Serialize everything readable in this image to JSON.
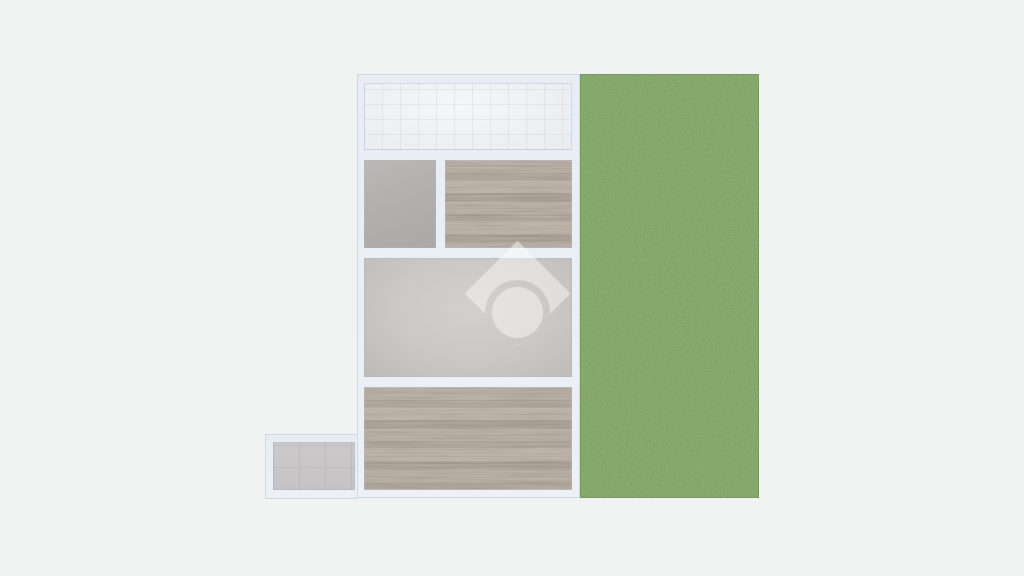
{
  "scene": {
    "background": "#f1f2f2",
    "width": 1024,
    "height": 576
  },
  "palette": {
    "wall_fill": "#e9eef4",
    "wall_edge": "#cdd8e4",
    "grass_green": "#7ba25f",
    "wood_brown": "#a79c8f",
    "concrete_gray": "#aeabа8",
    "plaster_gray": "#c8c5c2",
    "tile_white": "#eef0f2",
    "tile_gray": "#c6c4c5",
    "watermark_white": "rgba(255,255,255,0.44)"
  },
  "plan": {
    "walls": [
      {
        "name": "building-walls",
        "x": 357,
        "y": 74,
        "w": 223,
        "h": 424
      },
      {
        "name": "annex-walls",
        "x": 265,
        "y": 434,
        "w": 93,
        "h": 65
      }
    ],
    "rooms": [
      {
        "name": "room-tile-top",
        "floor": "tile-light",
        "x": 364,
        "y": 83,
        "w": 208,
        "h": 67
      },
      {
        "name": "room-concrete",
        "floor": "concrete",
        "x": 364,
        "y": 160,
        "w": 72,
        "h": 88
      },
      {
        "name": "room-wood-upper",
        "floor": "wood",
        "x": 445,
        "y": 160,
        "w": 127,
        "h": 88
      },
      {
        "name": "room-plaster-middle",
        "floor": "plaster",
        "x": 364,
        "y": 258,
        "w": 208,
        "h": 119
      },
      {
        "name": "room-wood-lower",
        "floor": "wood",
        "x": 364,
        "y": 387,
        "w": 208,
        "h": 103
      },
      {
        "name": "room-annex",
        "floor": "tile-gray",
        "x": 273,
        "y": 442,
        "w": 82,
        "h": 48
      }
    ],
    "garden": {
      "name": "garden-grass",
      "floor": "grass",
      "x": 580,
      "y": 74,
      "w": 179,
      "h": 424
    }
  },
  "watermark": {
    "icon": "house-logo",
    "color": "rgba(255,255,255,0.44)",
    "diamond": {
      "cx": 517,
      "cy": 293,
      "side": 75
    },
    "notch": {
      "r": 33,
      "dy": 19
    },
    "ball": {
      "cx": 517,
      "cy": 312,
      "r": 25.5
    }
  }
}
